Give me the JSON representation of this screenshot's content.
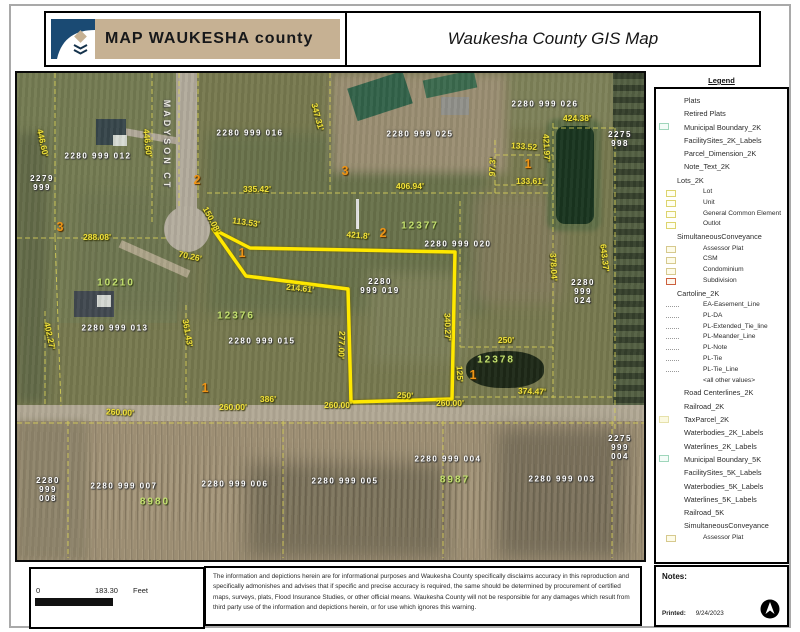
{
  "header": {
    "logo_text": "MAP WAUKESHA county",
    "title": "Waukesha County GIS Map"
  },
  "legend": {
    "title": "Legend",
    "items": [
      {
        "label": "Plats",
        "level": "item",
        "swatch": "none"
      },
      {
        "label": "Retired Plats",
        "level": "item",
        "swatch": "none"
      },
      {
        "label": "Municipal Boundary_2K",
        "level": "item",
        "swatch": "teal"
      },
      {
        "label": "FacilitySites_2K_Labels",
        "level": "item",
        "swatch": "none"
      },
      {
        "label": "Parcel_Dimension_2K",
        "level": "item",
        "swatch": "none"
      },
      {
        "label": "Note_Text_2K",
        "level": "item",
        "swatch": "none"
      },
      {
        "label": "Lots_2K",
        "level": "group",
        "swatch": "none"
      },
      {
        "label": "Lot",
        "level": "sub",
        "swatch": "yellow"
      },
      {
        "label": "Unit",
        "level": "sub",
        "swatch": "yellow"
      },
      {
        "label": "General Common Element",
        "level": "sub",
        "swatch": "yellow"
      },
      {
        "label": "Outlot",
        "level": "sub",
        "swatch": "yellow"
      },
      {
        "label": "SimultaneousConveyance",
        "level": "group",
        "swatch": "none"
      },
      {
        "label": "Assessor Plat",
        "level": "sub",
        "swatch": "cream"
      },
      {
        "label": "CSM",
        "level": "sub",
        "swatch": "cream"
      },
      {
        "label": "Condominium",
        "level": "sub",
        "swatch": "cream"
      },
      {
        "label": "Subdivision",
        "level": "sub",
        "swatch": "red"
      },
      {
        "label": "Cartoline_2K",
        "level": "group",
        "swatch": "none"
      },
      {
        "label": "EA-Easement_Line",
        "level": "sub",
        "swatch": "line"
      },
      {
        "label": "PL-DA",
        "level": "sub",
        "swatch": "line"
      },
      {
        "label": "PL-Extended_Tie_line",
        "level": "sub",
        "swatch": "line"
      },
      {
        "label": "PL-Meander_Line",
        "level": "sub",
        "swatch": "line"
      },
      {
        "label": "PL-Note",
        "level": "sub",
        "swatch": "line"
      },
      {
        "label": "PL-Tie",
        "level": "sub",
        "swatch": "line"
      },
      {
        "label": "PL-Tie_Line",
        "level": "sub",
        "swatch": "line"
      },
      {
        "label": "<all other values>",
        "level": "sub",
        "swatch": "none"
      },
      {
        "label": "Road Centerlines_2K",
        "level": "item",
        "swatch": "none"
      },
      {
        "label": "Railroad_2K",
        "level": "item",
        "swatch": "none"
      },
      {
        "label": "TaxParcel_2K",
        "level": "item",
        "swatch": "pale"
      },
      {
        "label": "Waterbodies_2K_Labels",
        "level": "item",
        "swatch": "none"
      },
      {
        "label": "Waterlines_2K_Labels",
        "level": "item",
        "swatch": "none"
      },
      {
        "label": "Municipal Boundary_5K",
        "level": "item",
        "swatch": "teal"
      },
      {
        "label": "FacilitySites_5K_Labels",
        "level": "item",
        "swatch": "none"
      },
      {
        "label": "Waterbodies_5K_Labels",
        "level": "item",
        "swatch": "none"
      },
      {
        "label": "Waterlines_5K_Labels",
        "level": "item",
        "swatch": "none"
      },
      {
        "label": "Railroad_5K",
        "level": "item",
        "swatch": "none"
      },
      {
        "label": "SimultaneousConveyance",
        "level": "item",
        "swatch": "none"
      },
      {
        "label": "Assessor Plat",
        "level": "sub",
        "swatch": "cream"
      }
    ]
  },
  "map": {
    "street": {
      "t": "MADYSON CT",
      "x": 150,
      "y": 72,
      "r": 90
    },
    "labels": {
      "parcels": [
        {
          "t": "2280 999 012",
          "x": 81,
          "y": 83
        },
        {
          "t": "2279\n999",
          "x": 25,
          "y": 110
        },
        {
          "t": "2280 999 016",
          "x": 233,
          "y": 60
        },
        {
          "t": "2280 999 025",
          "x": 403,
          "y": 61
        },
        {
          "t": "2280 999 026",
          "x": 528,
          "y": 31
        },
        {
          "t": "2275\n998",
          "x": 603,
          "y": 66
        },
        {
          "t": "2280 999 020",
          "x": 441,
          "y": 171
        },
        {
          "t": "2280\n999 019",
          "x": 363,
          "y": 213
        },
        {
          "t": "2280\n999\n024",
          "x": 566,
          "y": 219
        },
        {
          "t": "2280 999 013",
          "x": 98,
          "y": 255
        },
        {
          "t": "2280 999 015",
          "x": 245,
          "y": 268
        },
        {
          "t": "2280\n999\n008",
          "x": 31,
          "y": 417
        },
        {
          "t": "2280 999 007",
          "x": 107,
          "y": 413
        },
        {
          "t": "2280 999 006",
          "x": 218,
          "y": 411
        },
        {
          "t": "2280 999 005",
          "x": 328,
          "y": 408
        },
        {
          "t": "2280 999 004",
          "x": 431,
          "y": 386
        },
        {
          "t": "2280 999 003",
          "x": 545,
          "y": 406
        },
        {
          "t": "2275\n999\n004",
          "x": 603,
          "y": 375
        }
      ],
      "addresses": [
        {
          "t": "10210",
          "x": 99,
          "y": 210
        },
        {
          "t": "12376",
          "x": 219,
          "y": 243
        },
        {
          "t": "12377",
          "x": 403,
          "y": 153
        },
        {
          "t": "12378",
          "x": 479,
          "y": 287
        },
        {
          "t": "8980",
          "x": 138,
          "y": 429
        },
        {
          "t": "8987",
          "x": 438,
          "y": 407
        }
      ],
      "lots": [
        {
          "t": "2",
          "x": 180,
          "y": 107
        },
        {
          "t": "3",
          "x": 43,
          "y": 154
        },
        {
          "t": "1",
          "x": 225,
          "y": 180
        },
        {
          "t": "3",
          "x": 328,
          "y": 98
        },
        {
          "t": "2",
          "x": 366,
          "y": 160
        },
        {
          "t": "1",
          "x": 511,
          "y": 91
        },
        {
          "t": "1",
          "x": 188,
          "y": 315
        },
        {
          "t": "1",
          "x": 456,
          "y": 302
        }
      ],
      "dimensions": [
        {
          "t": "446.60'",
          "x": 25,
          "y": 70,
          "r": 78
        },
        {
          "t": "446.60'",
          "x": 130,
          "y": 70,
          "r": 84
        },
        {
          "t": "347.31'",
          "x": 300,
          "y": 44,
          "r": 75
        },
        {
          "t": "335.42'",
          "x": 240,
          "y": 117,
          "r": 0
        },
        {
          "t": "406.94'",
          "x": 393,
          "y": 114,
          "r": 0
        },
        {
          "t": "424.38'",
          "x": 560,
          "y": 46,
          "r": 0
        },
        {
          "t": "288.08'",
          "x": 80,
          "y": 165,
          "r": 0
        },
        {
          "t": "113.53'",
          "x": 229,
          "y": 150,
          "r": 8
        },
        {
          "t": "150.08'",
          "x": 194,
          "y": 147,
          "r": 62
        },
        {
          "t": "70.26'",
          "x": 173,
          "y": 184,
          "r": 12
        },
        {
          "t": "421.8'",
          "x": 341,
          "y": 163,
          "r": 5
        },
        {
          "t": "97.3'",
          "x": 476,
          "y": 94,
          "r": -88
        },
        {
          "t": "133.52",
          "x": 507,
          "y": 74,
          "r": 4
        },
        {
          "t": "133.61'",
          "x": 513,
          "y": 109,
          "r": 0
        },
        {
          "t": "421.97'",
          "x": 529,
          "y": 75,
          "r": 87
        },
        {
          "t": "643.37'",
          "x": 587,
          "y": 185,
          "r": 83
        },
        {
          "t": "378.04'",
          "x": 536,
          "y": 194,
          "r": 87
        },
        {
          "t": "214.61'",
          "x": 283,
          "y": 216,
          "r": 6
        },
        {
          "t": "277.00'",
          "x": 324,
          "y": 272,
          "r": 92
        },
        {
          "t": "340.27'",
          "x": 430,
          "y": 254,
          "r": 88
        },
        {
          "t": "361.43'",
          "x": 170,
          "y": 260,
          "r": 80
        },
        {
          "t": "402.27'",
          "x": 32,
          "y": 263,
          "r": 78
        },
        {
          "t": "125'",
          "x": 442,
          "y": 301,
          "r": 87
        },
        {
          "t": "250'",
          "x": 388,
          "y": 323,
          "r": 3
        },
        {
          "t": "250'",
          "x": 489,
          "y": 268,
          "r": 0
        },
        {
          "t": "386'",
          "x": 251,
          "y": 327,
          "r": 0
        },
        {
          "t": "260.00'",
          "x": 103,
          "y": 340,
          "r": 3
        },
        {
          "t": "260.00'",
          "x": 216,
          "y": 335,
          "r": 0
        },
        {
          "t": "260.00'",
          "x": 321,
          "y": 333,
          "r": 0
        },
        {
          "t": "260.00'",
          "x": 433,
          "y": 331,
          "r": 0
        },
        {
          "t": "374.47'",
          "x": 515,
          "y": 319,
          "r": 2
        }
      ]
    }
  },
  "scale": {
    "zero": "0",
    "distance": "183.30",
    "unit": "Feet"
  },
  "disclaimer": "The information and depictions herein are for informational purposes and Waukesha County specifically disclaims accuracy in this reproduction and specifically admonishes and advises that if specific and precise accuracy is required, the same should be determined by procurement of certified maps, surveys, plats, Flood Insurance Studies, or other official means. Waukesha County will not be responsible for any damages which result from third party use of the information and depictions herein, or for use which ignores this warning.",
  "notes": {
    "title": "Notes:",
    "printed_label": "Printed:",
    "printed_date": "9/24/2023"
  },
  "colors": {
    "highlight_parcel": "#ffe800",
    "parcel_line": "#d9d157",
    "dimension_text": "#f1e13b",
    "parcel_id_text": "#ffffff",
    "address_text": "#c3e06f",
    "lot_number_text": "#ef9415",
    "logo_banner": "#c6b193",
    "logo_blue": "#1a4a73"
  }
}
